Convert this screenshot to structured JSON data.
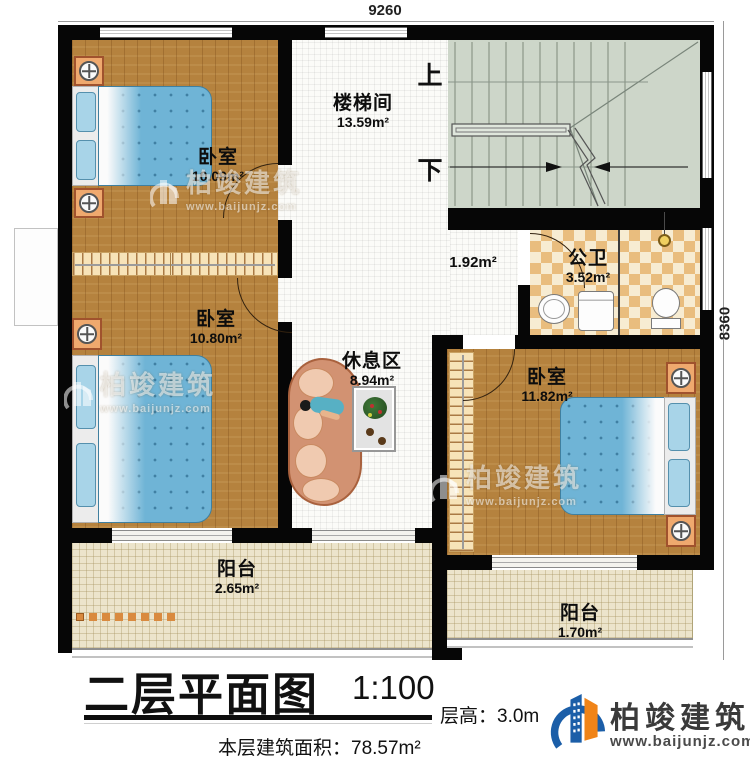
{
  "dimensions": {
    "width_mm": "9260",
    "height_mm": "8360"
  },
  "stairs": {
    "up_label": "上",
    "down_label": "下"
  },
  "rooms": {
    "bedroom_top_left": {
      "label": "卧室",
      "area": "10.09m²"
    },
    "bedroom_mid_left": {
      "label": "卧室",
      "area": "10.80m²"
    },
    "stairwell": {
      "label": "楼梯间",
      "area": "13.59m²"
    },
    "hallway": {
      "area": "1.92m²"
    },
    "bathroom": {
      "label": "公卫",
      "area": "3.52m²"
    },
    "lounge": {
      "label": "休息区",
      "area": "8.94m²"
    },
    "bedroom_right": {
      "label": "卧室",
      "area": "11.82m²"
    },
    "balcony_left": {
      "label": "阳台",
      "area": "2.65m²"
    },
    "balcony_right": {
      "label": "阳台",
      "area": "1.70m²"
    }
  },
  "title_block": {
    "title": "二层平面图",
    "scale": "1:100",
    "floor_height": "层高：3.0m",
    "floor_area": "本层建筑面积：78.57m²"
  },
  "brand": {
    "name": "柏竣建筑",
    "website": "www.baijunjz.com"
  },
  "watermark": {
    "name": "柏竣建筑",
    "website": "www.baijunjz.com"
  },
  "colors": {
    "wall": "#060606",
    "wood_floor": "#b5823e",
    "tile": "#fbfbf8",
    "balcony": "#ece4cb",
    "bath_tile": "#e9bd7e",
    "stairs": "#cdd6c9",
    "bed": "#6fb4d6",
    "accent_orange": "#efa96e",
    "brand_blue": "#1b5ea8",
    "brand_orange": "#f08418"
  }
}
